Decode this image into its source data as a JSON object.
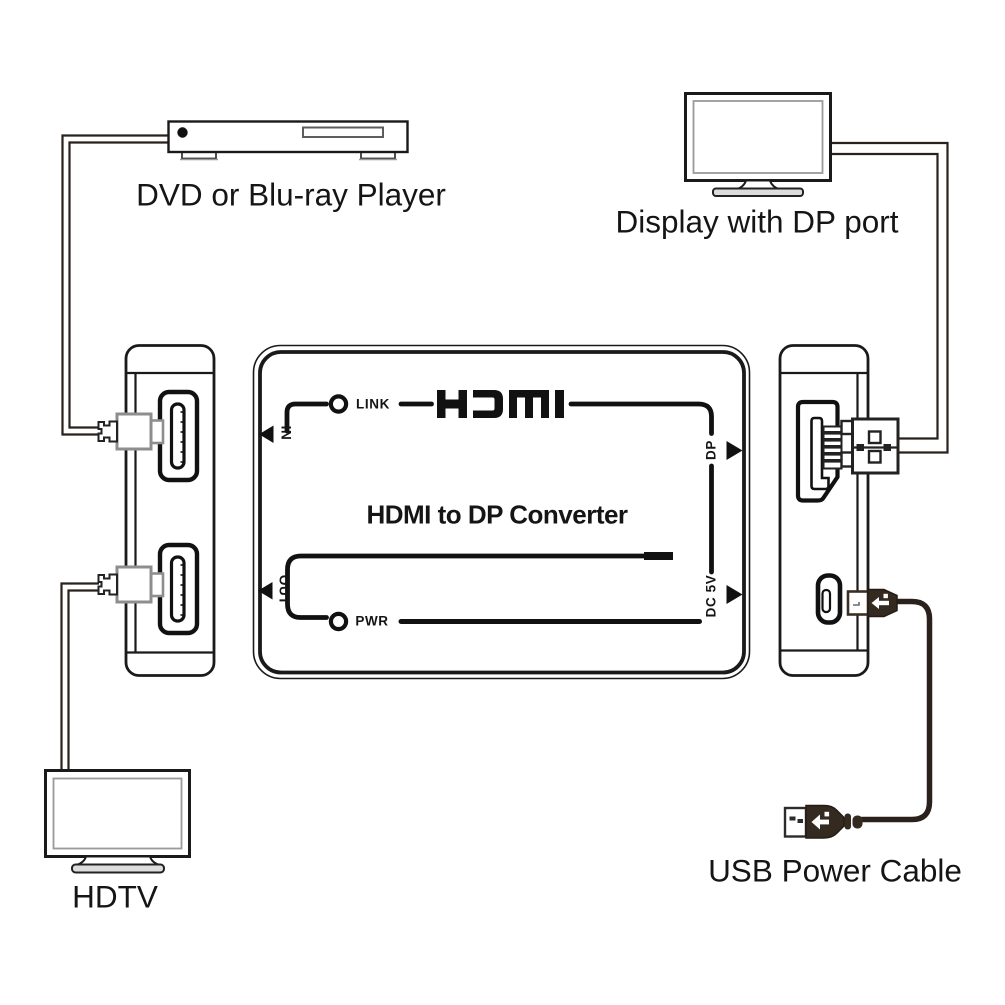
{
  "diagram": {
    "devices": {
      "dvd_player": {
        "label": "DVD or Blu-ray Player"
      },
      "display": {
        "label": "Display with DP port"
      },
      "hdtv": {
        "label": "HDTV"
      },
      "usb_power_cable": {
        "label": "USB Power Cable"
      }
    },
    "converter": {
      "title": "HDMI to DP Converter",
      "logo": "HDMI",
      "indicators": {
        "link": "LINK",
        "pwr": "PWR"
      },
      "ports": {
        "in": "IN",
        "out": "OUT",
        "dp": "DP",
        "dc5v": "DC 5V"
      }
    },
    "colors": {
      "line": "#231f1c",
      "text": "#151515",
      "dark_plug": "#352a20",
      "grey_plug": "#8e8e8e",
      "background": "#ffffff"
    }
  }
}
